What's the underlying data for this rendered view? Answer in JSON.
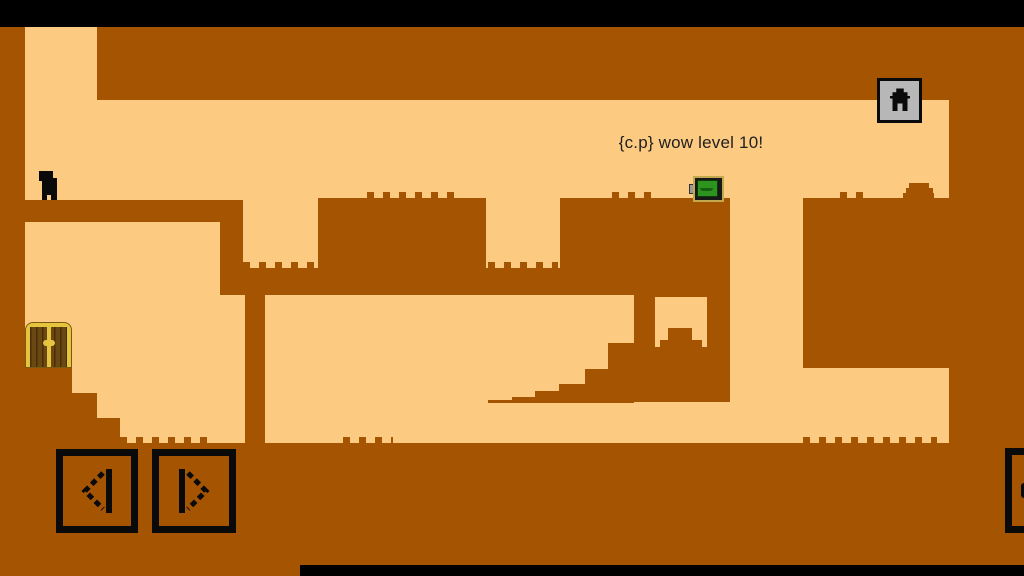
{
  "hud": {
    "message": "{c.p} wow level 10!",
    "home_button": {
      "icon": "home-icon"
    },
    "controls": [
      {
        "id": "move-left",
        "icon": "arrow-left-icon"
      },
      {
        "id": "move-right",
        "icon": "arrow-right-icon"
      },
      {
        "id": "partial-right-edge",
        "icon": "partial-button-icon"
      }
    ]
  },
  "entities": {
    "player": {
      "name": "player-character",
      "color": "#0a0a0a"
    },
    "exit_door": {
      "name": "wooden-double-door",
      "frame_color": "#e7c43e",
      "wood_color": "#6b4712"
    },
    "battery": {
      "name": "green-screen-device",
      "screen_color": "#2e9420",
      "shell_color": "#c2a94e"
    }
  },
  "colors": {
    "brown": "#a55502",
    "tan": "#fcca81",
    "ink": "#0a0a0a",
    "gold": "#e7c43e",
    "golddark": "#7a5a10",
    "wood": "#6b4712",
    "woodline": "#44300a",
    "green": "#2e9420",
    "greendark": "#156010",
    "shell": "#c2a94e",
    "gray": "#b7b7b7",
    "text": "#1f1f1f"
  },
  "level": {
    "rects": [
      {
        "name": "left-wall",
        "x": 0,
        "y": 27,
        "w": 25,
        "h": 416
      },
      {
        "name": "top-mass",
        "x": 97,
        "y": 27,
        "w": 852,
        "h": 73
      },
      {
        "name": "right-wall",
        "x": 949,
        "y": 27,
        "w": 75,
        "h": 416
      },
      {
        "name": "ground",
        "x": 0,
        "y": 443,
        "w": 1024,
        "h": 133
      },
      {
        "name": "spawn-platform",
        "x": 0,
        "y": 200,
        "w": 243,
        "h": 22
      },
      {
        "name": "upper-column",
        "x": 220,
        "y": 222,
        "w": 23,
        "h": 50
      },
      {
        "name": "mid-band",
        "x": 220,
        "y": 268,
        "w": 510,
        "h": 27
      },
      {
        "name": "center-block",
        "x": 318,
        "y": 198,
        "w": 168,
        "h": 97
      },
      {
        "name": "battery-block",
        "x": 560,
        "y": 198,
        "w": 170,
        "h": 97
      },
      {
        "name": "battery-block-lower",
        "x": 634,
        "y": 295,
        "w": 96,
        "h": 107
      },
      {
        "name": "block-window",
        "x": 655,
        "y": 297,
        "w": 52,
        "h": 50,
        "c": "tan"
      },
      {
        "name": "window-rock-top",
        "x": 668,
        "y": 328,
        "w": 24,
        "h": 12
      },
      {
        "name": "window-rock-base",
        "x": 660,
        "y": 340,
        "w": 42,
        "h": 7
      },
      {
        "name": "right-block",
        "x": 803,
        "y": 198,
        "w": 147,
        "h": 170
      },
      {
        "name": "lower-column",
        "x": 245,
        "y": 295,
        "w": 20,
        "h": 148
      },
      {
        "name": "door-step-1",
        "x": 0,
        "y": 368,
        "w": 72,
        "h": 25
      },
      {
        "name": "door-step-2",
        "x": 0,
        "y": 393,
        "w": 97,
        "h": 25
      },
      {
        "name": "door-step-3",
        "x": 0,
        "y": 418,
        "w": 120,
        "h": 25
      },
      {
        "name": "hang-stair-1",
        "x": 488,
        "y": 400,
        "w": 24,
        "h": 3
      },
      {
        "name": "hang-stair-2",
        "x": 512,
        "y": 397,
        "w": 23,
        "h": 6
      },
      {
        "name": "hang-stair-3",
        "x": 535,
        "y": 391,
        "w": 24,
        "h": 12
      },
      {
        "name": "hang-stair-4",
        "x": 559,
        "y": 384,
        "w": 26,
        "h": 19
      },
      {
        "name": "hang-stair-5",
        "x": 585,
        "y": 369,
        "w": 23,
        "h": 34
      },
      {
        "name": "hang-stair-6",
        "x": 608,
        "y": 343,
        "w": 26,
        "h": 60
      },
      {
        "name": "mesa-rock-top",
        "x": 909,
        "y": 183,
        "w": 20,
        "h": 10
      },
      {
        "name": "mesa-rock-mid",
        "x": 906,
        "y": 188,
        "w": 27,
        "h": 5
      },
      {
        "name": "mesa-rock-base",
        "x": 903,
        "y": 193,
        "w": 31,
        "h": 5
      }
    ],
    "bumps": [
      {
        "x": 243,
        "y": 262,
        "w": 74
      },
      {
        "x": 488,
        "y": 262,
        "w": 70
      },
      {
        "x": 367,
        "y": 192,
        "w": 93
      },
      {
        "x": 612,
        "y": 192,
        "w": 46
      },
      {
        "x": 840,
        "y": 192,
        "w": 24
      },
      {
        "x": 120,
        "y": 437,
        "w": 88
      },
      {
        "x": 343,
        "y": 437,
        "w": 50
      },
      {
        "x": 803,
        "y": 437,
        "w": 134
      }
    ]
  }
}
